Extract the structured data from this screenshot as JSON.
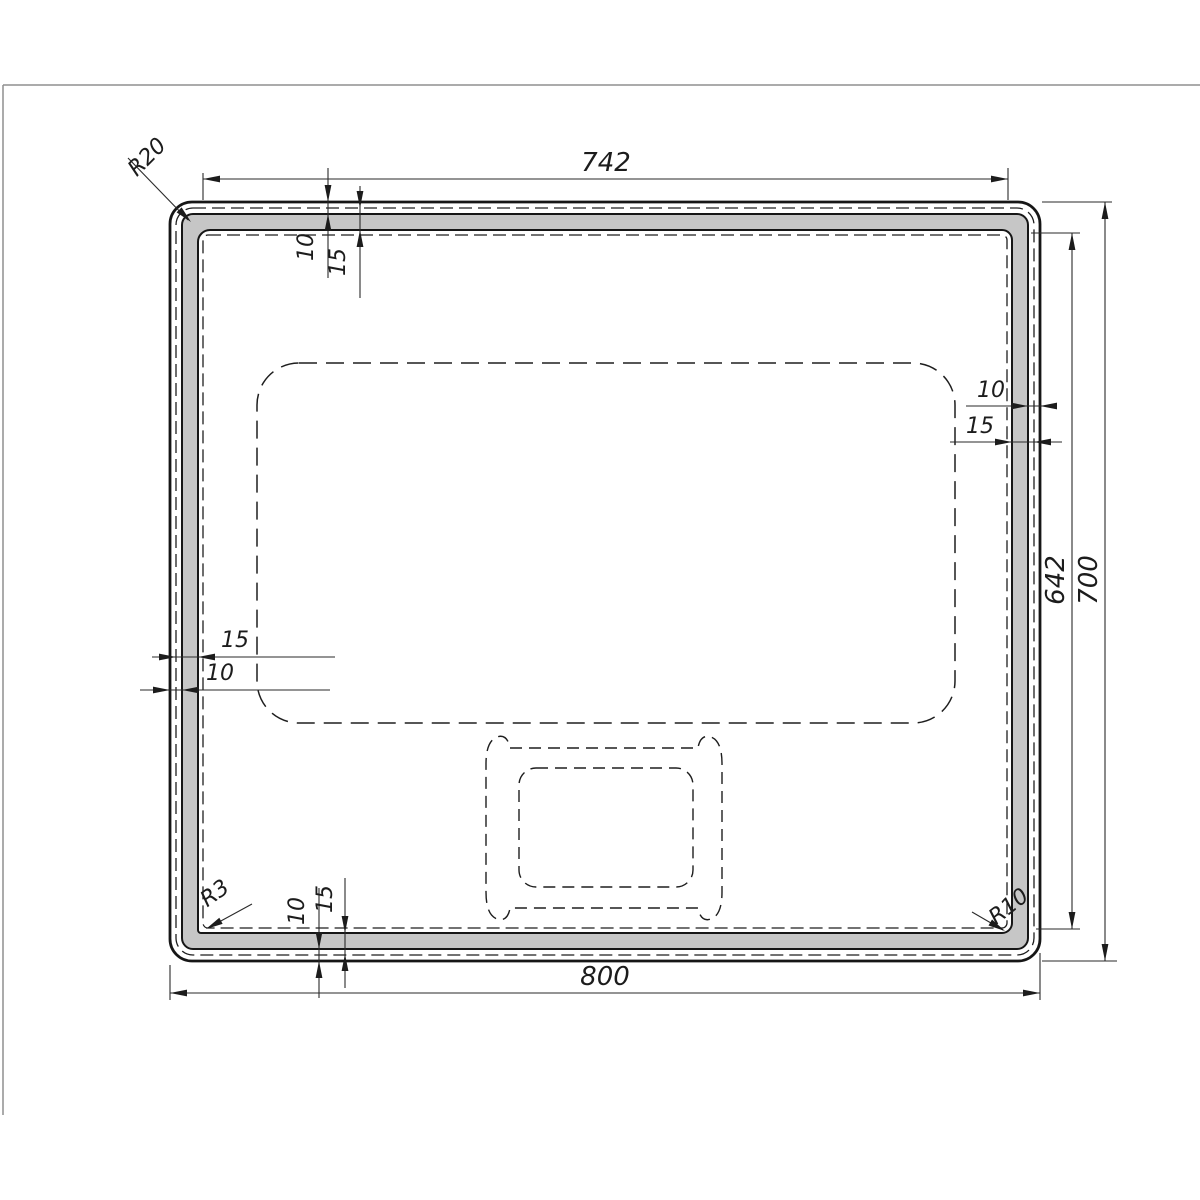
{
  "title": "Mirror technical drawing",
  "canvas": {
    "background": "#ffffff",
    "border_color": "#8f8f8f"
  },
  "style": {
    "line_color": "#1c1c1c",
    "band_fill": "#c6c6c6"
  },
  "dims": {
    "width_top": "742",
    "width_bottom": "800",
    "height_outer": "700",
    "height_inner": "642",
    "top_offset": "10",
    "top_band": "15",
    "right_offset": "10",
    "right_band": "15",
    "left_band": "15",
    "left_offset": "10",
    "bottom_offset": "10",
    "bottom_band": "15",
    "radius_outer_top_left": "R20",
    "radius_inner_bottom_left": "R3",
    "radius_inner_bottom_right": "R10"
  }
}
